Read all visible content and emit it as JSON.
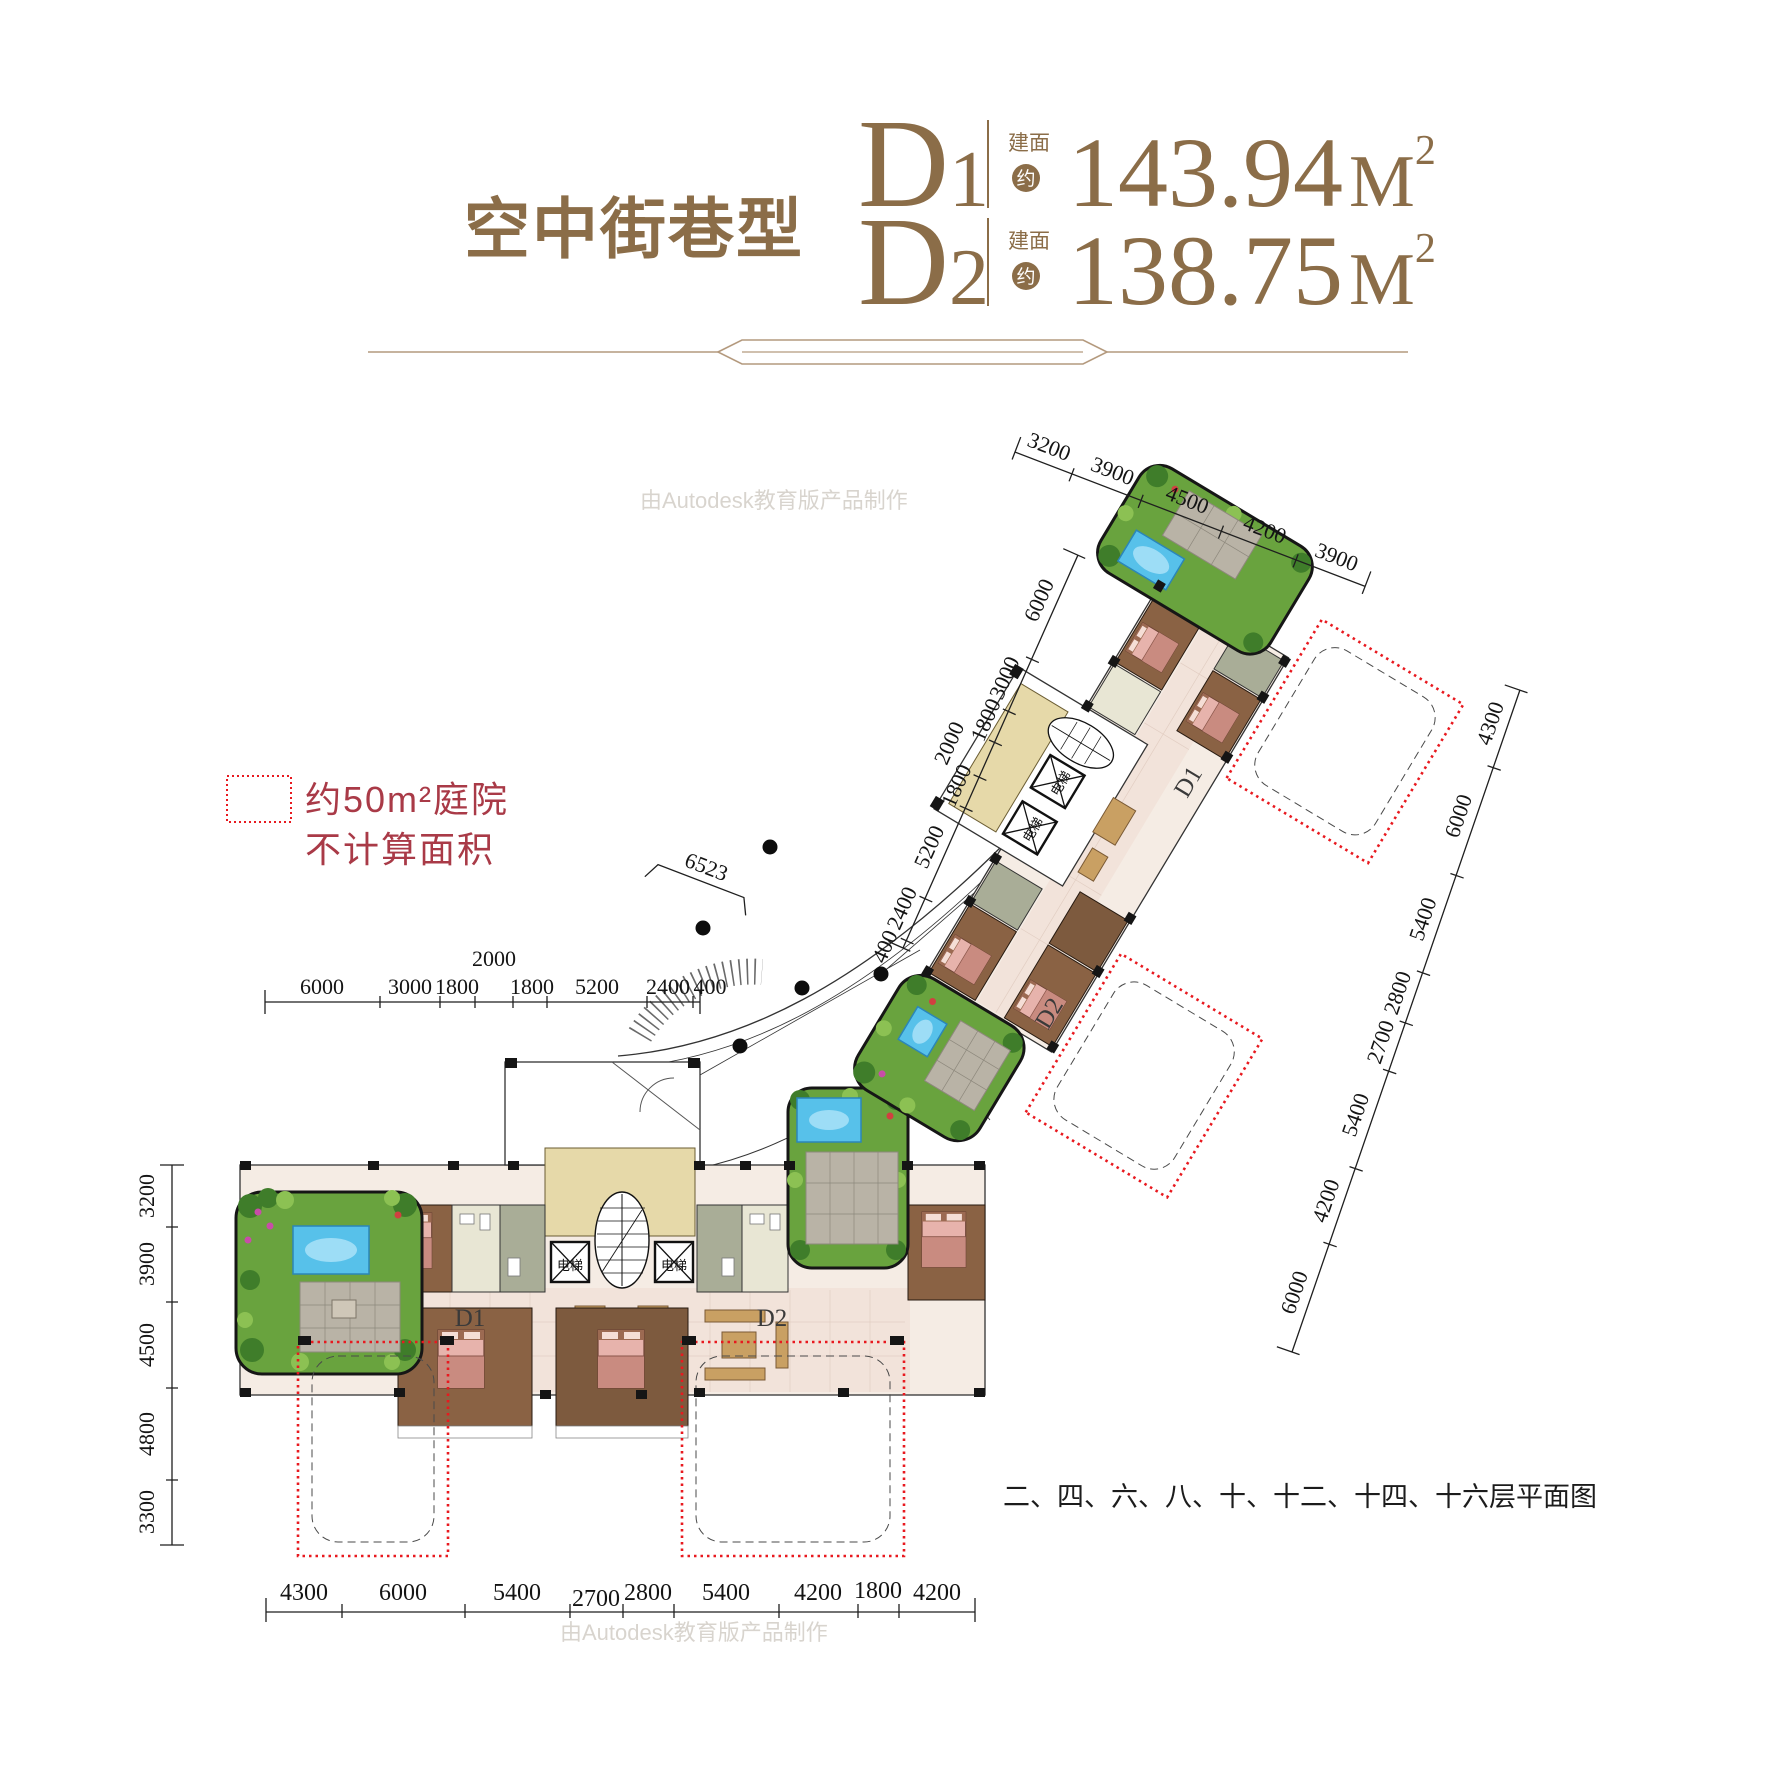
{
  "header": {
    "title": "空中街巷型",
    "units": [
      {
        "letter": "D",
        "digit": "1",
        "prefix": "建面",
        "approx": "约",
        "value": "143.94",
        "unit": "M",
        "sup": "2"
      },
      {
        "letter": "D",
        "digit": "2",
        "prefix": "建面",
        "approx": "约",
        "value": "138.75",
        "unit": "M",
        "sup": "2"
      }
    ]
  },
  "legend": {
    "line1": "约50m²庭院",
    "line2": "不计算面积"
  },
  "caption": "二、四、六、八、十、十二、十四、十六层平面图",
  "watermark": "由Autodesk教育版产品制作",
  "plan": {
    "d1": "D1",
    "d2": "D2",
    "elevator": "电梯",
    "street_dim": "6523"
  },
  "dims": {
    "lbt": [
      "6000",
      "3000",
      "1800",
      "2000",
      "1800",
      "5200",
      "2400",
      "400"
    ],
    "lbl": [
      "3200",
      "3900",
      "4500",
      "4800",
      "3300"
    ],
    "lbb": [
      "4300",
      "6000",
      "5400",
      "2700",
      "2800",
      "5400",
      "4200",
      "1800",
      "4200"
    ],
    "rbt": [
      "3200",
      "3900",
      "4500",
      "4200",
      "3900"
    ],
    "rbl": [
      "6000",
      "3000",
      "1800",
      "2000",
      "1800",
      "5200",
      "2400",
      "400"
    ],
    "rbr": [
      "4300",
      "6000",
      "5400",
      "2800",
      "2700",
      "5400",
      "4200",
      "6000"
    ]
  },
  "colors": {
    "title_brown": "#8b6d48",
    "divider_tan": "#b49a7e",
    "legend_red": "#a93a47",
    "courtyard_red": "#e8191f",
    "garden_green": "#69a33e",
    "pool_blue": "#57c1ea",
    "wood_brown": "#8a6244",
    "floor_cream": "#f5ece4",
    "wall_black": "#151515"
  }
}
